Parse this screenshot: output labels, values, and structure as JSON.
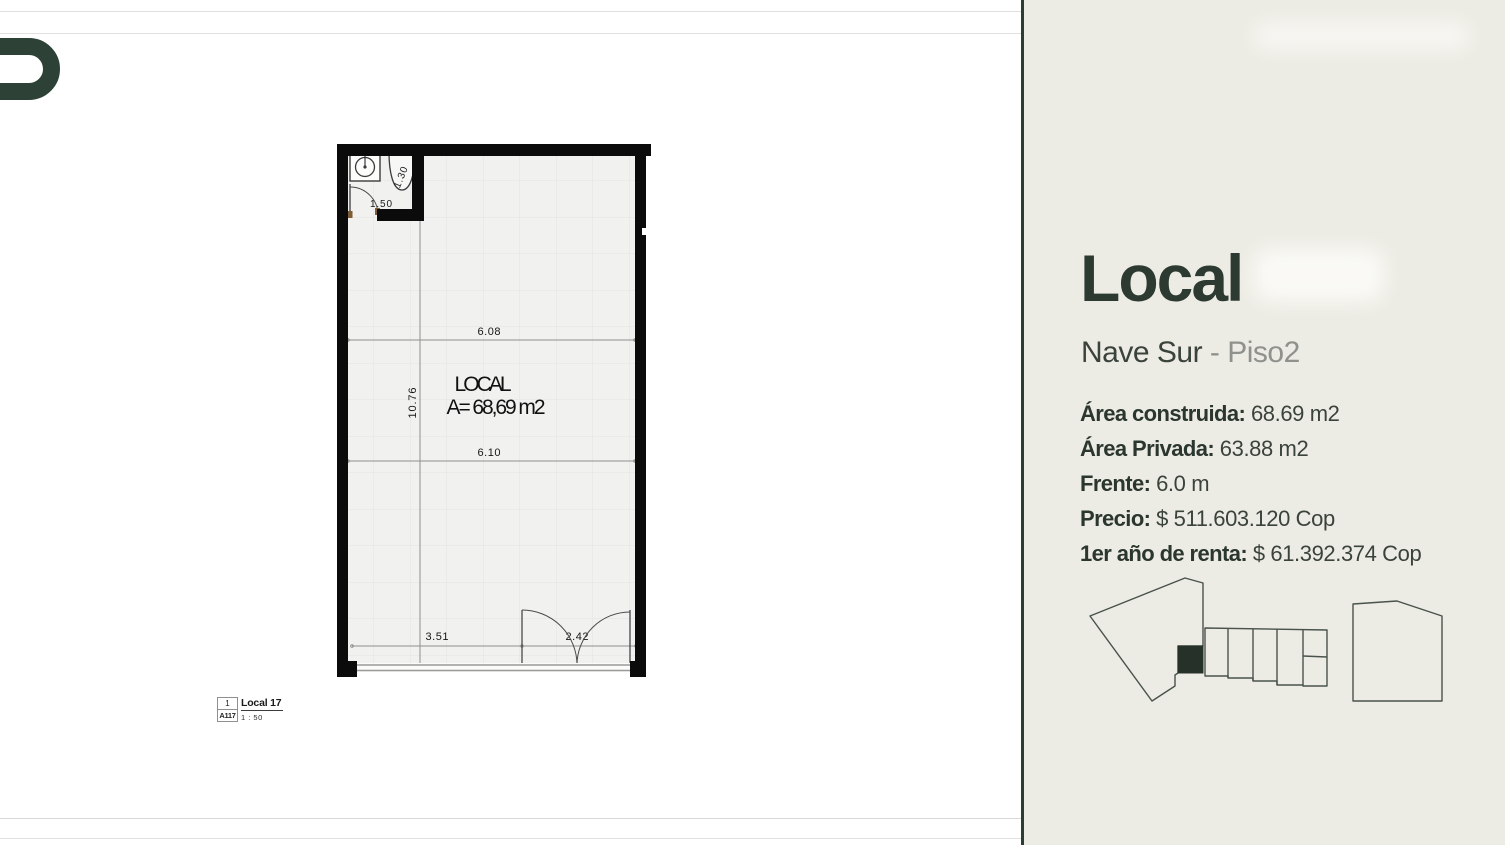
{
  "plan": {
    "room_label": "LOCAL",
    "area_label": "A= 68,69 m2",
    "dim_width_top": "6.08",
    "dim_width_mid": "6.10",
    "dim_height": "10.76",
    "dim_bottom_left": "3.51",
    "dim_door": "2.42",
    "dim_bath_door": "1.50",
    "dim_toilet": "1.30"
  },
  "title_block": {
    "view_number": "1",
    "sheet_ref": "A117",
    "view_name": "Local 17",
    "scale": "1 : 50"
  },
  "panel": {
    "title": "Local",
    "location": "Nave Sur",
    "floor": "- Piso2",
    "specs": [
      {
        "label": "Área construida:",
        "value": "68.69 m2"
      },
      {
        "label": "Área Privada:",
        "value": "63.88 m2"
      },
      {
        "label": "Frente:",
        "value": "6.0 m"
      },
      {
        "label": "Precio:",
        "value": "$ 511.603.120 Cop"
      },
      {
        "label": "1er año de renta:",
        "value": "$ 61.392.374 Cop"
      }
    ]
  },
  "colors": {
    "accent_dark_green": "#2c3c33",
    "panel_background": "#edece4",
    "muted_gray": "#8f918c",
    "wall_black": "#0b0b0b",
    "plan_floor": "#f1f1ef",
    "site_plan_line": "#49524c",
    "highlight_unit_fill": "#263129"
  }
}
